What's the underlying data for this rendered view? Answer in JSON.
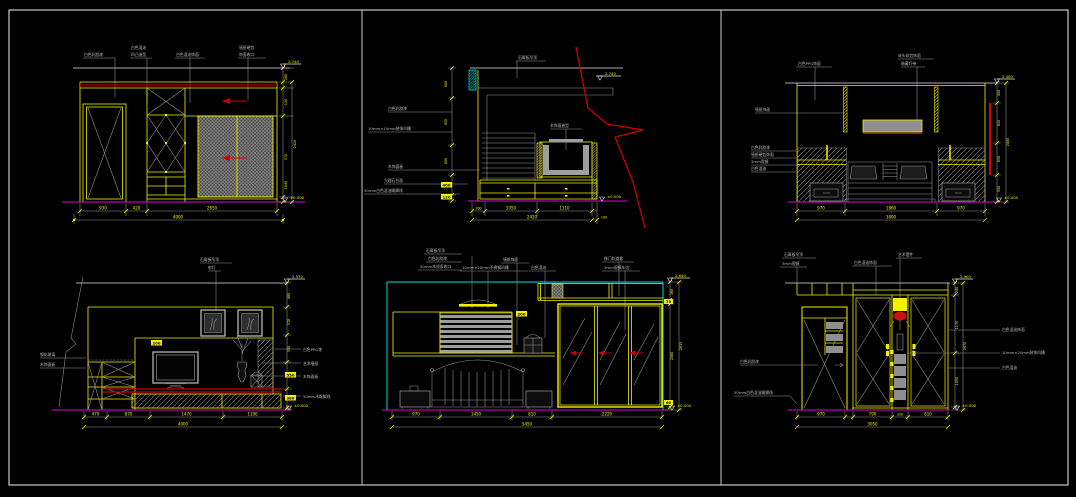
{
  "canvas": {
    "background": "#000000",
    "frame_color": "#c9c9c9"
  },
  "colors": {
    "line_yellow": "#f2f200",
    "line_gray": "#9a9a9a",
    "line_white": "#e6e6e6",
    "ground_magenta": "#e000e0",
    "accent_cyan": "#00dcdc",
    "accent_red": "#cf0000",
    "band_maroon": "#8f0000"
  },
  "panels": {
    "p1": {
      "name": "wardrobe-and-door-elevation",
      "top_labels": [
        "白色乳胶漆",
        "白色混油",
        "凹凸造型",
        "白色混油饰面",
        "墙纸硬包",
        "饰面收口"
      ],
      "dims_bottom": [
        "930",
        "420",
        "2650"
      ],
      "dim_total": "4000",
      "side_dims": [
        "280",
        "120",
        "570",
        "1640"
      ],
      "side_total": "2420",
      "flag_top": "2.740",
      "flag_bottom": "±0.000"
    },
    "p2": {
      "name": "tv-cabinet-section-detail",
      "top_label": "石膏板吊顶",
      "tv_label": "木饰面造型",
      "left_labels": [
        "白色乳胶漆",
        "10mm×10mm装饰凹槽",
        "木饰面板",
        "大理石台面",
        "50mm白色混油踢脚线"
      ],
      "side_dims": [
        "600",
        "950",
        "600",
        "400",
        "120"
      ],
      "dims_bottom": [
        "260",
        "1050",
        "1110"
      ],
      "dim_total": "2420",
      "dim_right_small": "100",
      "flag_top": "2.740",
      "flag_bottom": "±0.000"
    },
    "p3": {
      "name": "bed-headboard-wall-elevation",
      "top_labels": [
        "白色PPG饰面",
        "床头软包饰面",
        "暗藏灯带"
      ],
      "left_label": "墙纸饰面",
      "left_stack": [
        "白色乳胶漆",
        "墙纸硬包饰面",
        "3mm银镜",
        "白色混油"
      ],
      "dims_bottom": [
        "970",
        "1860",
        "970"
      ],
      "dim_total": "3800",
      "side_dims": [
        "400",
        "810",
        "650",
        "550"
      ],
      "side_total": "2400",
      "flag_top": "2.400",
      "flag_bottom": "±0.000"
    },
    "p4": {
      "name": "tv-wall-elevation",
      "top_labels": [
        "石膏板吊顶",
        "射灯"
      ],
      "left_labels": [
        "钢化玻璃",
        "木饰面板"
      ],
      "right_labels": [
        "白色PPG漆",
        "艺术墙纸",
        "木饰面板",
        "50mm木踢脚线"
      ],
      "tag": "200",
      "dims_bottom": [
        "470",
        "870",
        "1470",
        "1190"
      ],
      "dim_total": "4000",
      "side_dims": [
        "480",
        "570",
        "550",
        "550",
        "380"
      ],
      "flag_top": "2.570",
      "flag_bottom": "±0.000"
    },
    "p5": {
      "name": "bed-and-sliding-wardrobe-elevation",
      "top_labels_left": [
        "石膏板吊顶",
        "白色乳胶漆",
        "50mm木线条收口"
      ],
      "top_labels_mid": [
        "墙纸饰面",
        "10mm×20mm不锈钢凹槽",
        "白色混油"
      ],
      "top_labels_right": [
        "移门轨道盒",
        "3mm银镜车边"
      ],
      "tag": "200",
      "dims_bottom": [
        "970",
        "1450",
        "810",
        "2220"
      ],
      "dim_total": "5450",
      "side_dims": [
        "360",
        "75",
        "2080",
        "60"
      ],
      "side_total": "2635",
      "flag_top": "2.640",
      "flag_bottom": "±0.000"
    },
    "p6": {
      "name": "closet-display-niche-elevation",
      "top_labels_left": [
        "石膏板吊顶",
        "3mm银镜"
      ],
      "top_labels_mid": [
        "白色混油饰面",
        "艺术摆件"
      ],
      "left_labels": [
        "白色乳胶漆",
        "50mm白色混油踢脚线"
      ],
      "right_labels": [
        "白色混油饰面",
        "10mm×20mm装饰凹槽",
        "白色混油"
      ],
      "dims_bottom": [
        "970",
        "790",
        "320",
        "810"
      ],
      "dim_total": "3050",
      "side_dims": [
        "240",
        "1170",
        "1090"
      ],
      "side_total": "2670",
      "flag_top": "2.900",
      "flag_bottom": "±0.000"
    }
  }
}
